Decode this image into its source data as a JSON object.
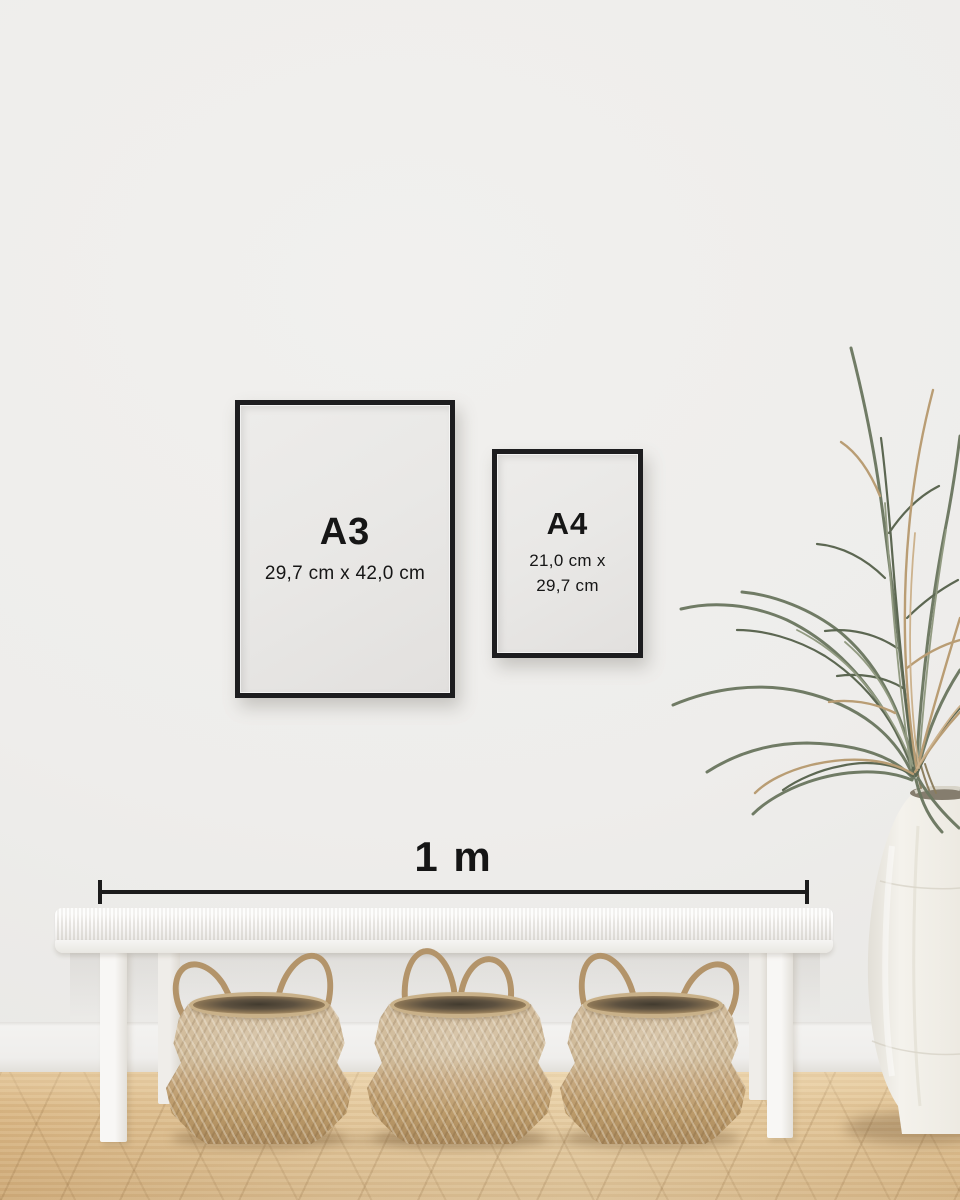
{
  "frames": {
    "a3": {
      "label": "A3",
      "dimensions": "29,7 cm x 42,0 cm"
    },
    "a4": {
      "label": "A4",
      "dimensions_line1": "21,0 cm x",
      "dimensions_line2": "29,7 cm"
    }
  },
  "scale": {
    "label": "1 m"
  },
  "colors": {
    "wall": "#efeeec",
    "frame": "#1d1d1f",
    "poster": "#e9e8e6",
    "text": "#161616",
    "scale_bar": "#1c1c1c",
    "floor_wood": "#dfc092",
    "bench": "#f5f4f2",
    "basket": "#c8b08a",
    "plant_green": "#6b7760",
    "plant_dried": "#b79a70",
    "vase": "#f0ede6"
  }
}
